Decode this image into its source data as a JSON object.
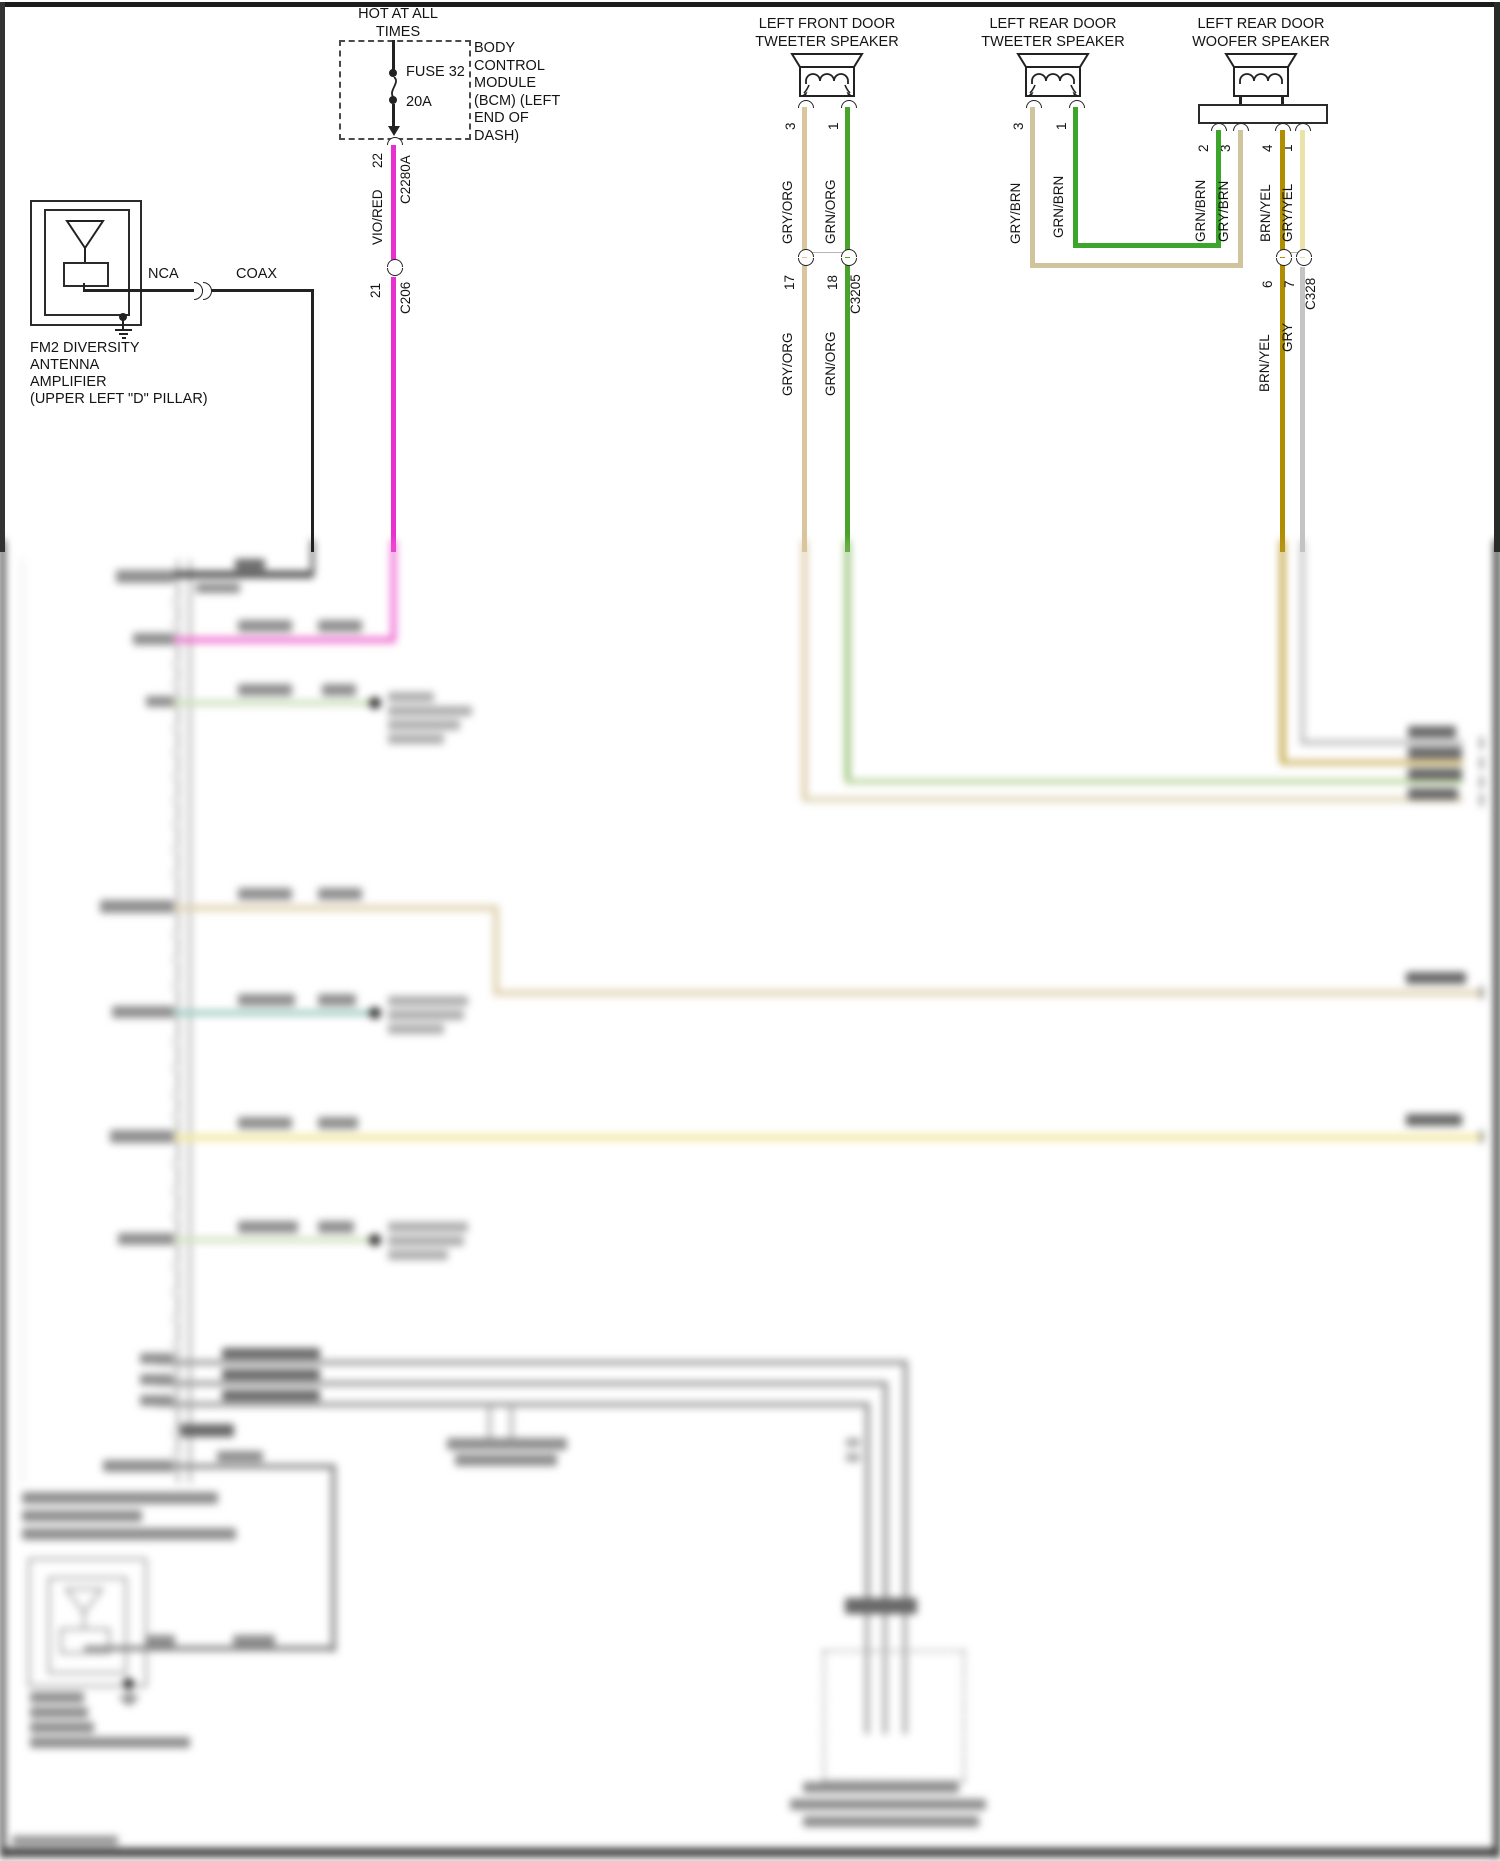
{
  "page": {
    "width": 1500,
    "height": 1861,
    "background": "#ffffff",
    "border_color": "#222222"
  },
  "bcm": {
    "hot_label": "HOT AT ALL TIMES",
    "fuse_label": "FUSE 32",
    "fuse_rating": "20A",
    "module_label": "BODY CONTROL MODULE (BCM) (LEFT END OF DASH)",
    "pin_top": "22",
    "connector_top": "C2280A",
    "wire_label": "VIO/RED",
    "pin_bottom": "21",
    "connector_bottom": "C206"
  },
  "antenna_fm2": {
    "nca": "NCA",
    "coax": "COAX",
    "lines": [
      "FM2 DIVERSITY",
      "ANTENNA",
      "AMPLIFIER",
      "(UPPER LEFT \"D\" PILLAR)"
    ]
  },
  "speakers": {
    "front_tweeter": {
      "title": "LEFT FRONT DOOR TWEETER SPEAKER",
      "pin_left": "3",
      "pin_right": "1",
      "wire_left": "GRY/ORG",
      "wire_right": "GRN/ORG",
      "conn_pin_left": "17",
      "conn_pin_right": "18",
      "conn_name": "C3205",
      "wire_left_below": "GRY/ORG",
      "wire_right_below": "GRN/ORG"
    },
    "rear_tweeter": {
      "title": "LEFT REAR DOOR TWEETER SPEAKER",
      "pin_left": "3",
      "pin_right": "1",
      "wire_left": "GRY/BRN",
      "wire_right": "GRN/BRN"
    },
    "rear_woofer": {
      "title": "LEFT REAR DOOR WOOFER SPEAKER",
      "pins": [
        "2",
        "3",
        "4",
        "1"
      ],
      "wires": [
        "GRN/BRN",
        "GRY/BRN",
        "BRN/YEL",
        "GRY/YEL"
      ],
      "conn": {
        "name": "C328",
        "pins": [
          "6",
          "7"
        ]
      },
      "wires_below": [
        "BRN/YEL",
        "GRY"
      ]
    }
  },
  "colors": {
    "vio_red": "#e92fd0",
    "gry_org": "#d9c59e",
    "grn_org": "#49a22a",
    "gry_brn": "#cfc49c",
    "grn_brn": "#3da52c",
    "brn_yel": "#b18e00",
    "gry_yel": "#eae2a8",
    "gry": "#c4c4c4",
    "coax": "#222222"
  }
}
